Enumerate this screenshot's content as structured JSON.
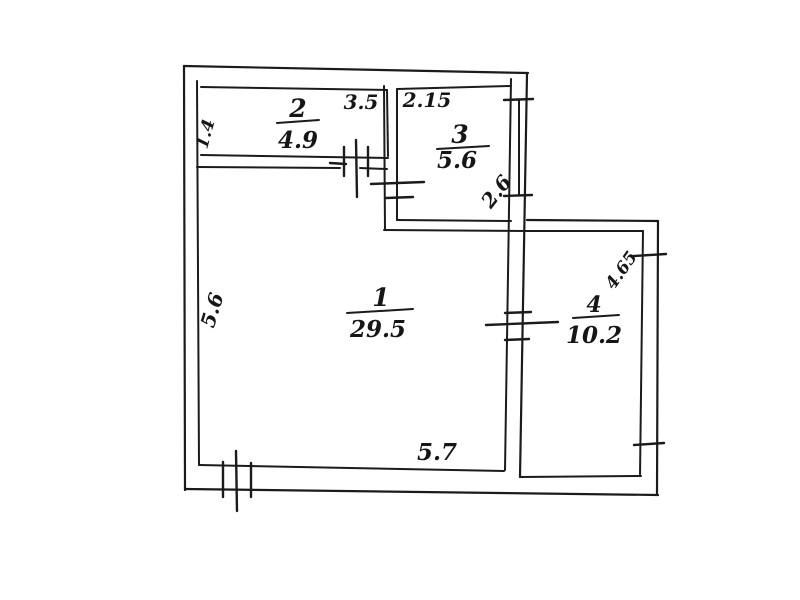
{
  "document": {
    "kind": "hand-drawn apartment floor plan sketch",
    "background": "#ffffff",
    "ink_color": "#1b1b1b"
  },
  "rooms": [
    {
      "number": "1",
      "area": "29.5"
    },
    {
      "number": "2",
      "area": "4.9"
    },
    {
      "number": "3",
      "area": "5.6"
    },
    {
      "number": "4",
      "area": "10.2"
    }
  ],
  "dimensions": {
    "room2_top": "3.5",
    "room2_left": "1.4",
    "room3_top": "2.15",
    "room3_right": "2.6",
    "room1_left": "5.6",
    "room1_bottom": "5.7",
    "room4_right": "4.65"
  },
  "symbols": {
    "windows": [
      "window on bottom wall of room 1",
      "window on wall between rooms 2 and 1",
      "window on right wall of room 3",
      "window on right wall of room 4"
    ],
    "doors": [
      "door opening to room 3",
      "door opening between rooms 1 and 4"
    ]
  }
}
